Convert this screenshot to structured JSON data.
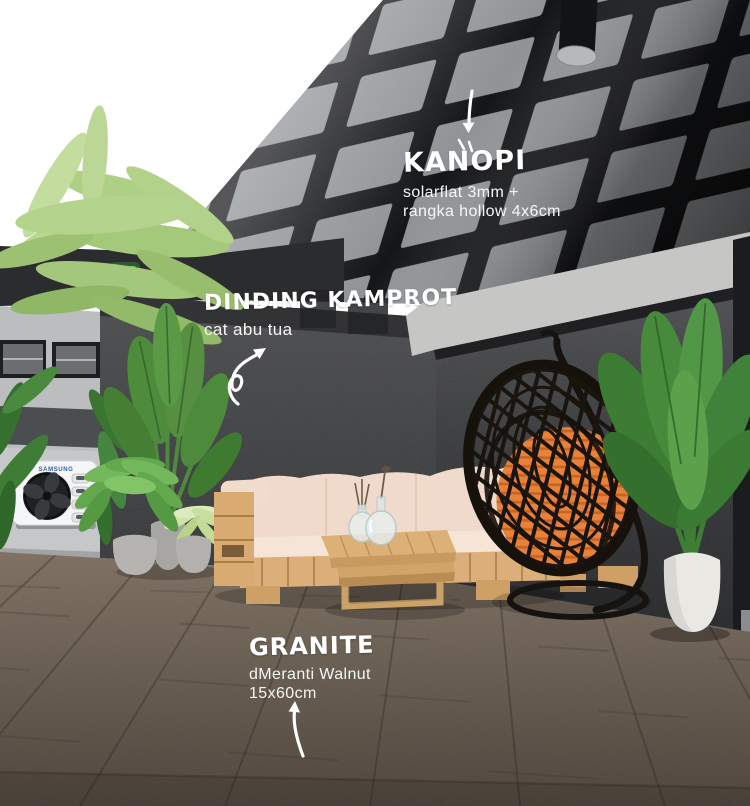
{
  "annotations": {
    "kanopi": {
      "title": "KANOPI",
      "detail_line1": "solarflat 3mm +",
      "detail_line2": "rangka hollow 4x6cm"
    },
    "dinding_kamprot": {
      "title": "DINDING KAMPROT",
      "detail_line1": "cat abu tua"
    },
    "granite": {
      "title": "GRANITE",
      "detail_line1": "dMeranti Walnut",
      "detail_line2": "15x60cm"
    }
  },
  "equipment": {
    "ac_brand": "SAMSUNG"
  },
  "icons": {
    "kanopi_arrow": "arrow-down-icon",
    "dinding_arrow": "curly-arrow-up-right-icon",
    "granite_arrow": "curved-arrow-up-icon"
  },
  "colors": {
    "canopy_frame": "#17181A",
    "canopy_panel": "#8F9396",
    "wall_kamprot": "#3C3D3F",
    "wall_cap": "#C7C7C5",
    "floor_wood": "#6B5E53",
    "sofa_wood": "#DCAE79",
    "sofa_cushion": "#F0DACB",
    "egg_chair_frame": "#17110C",
    "egg_chair_cushion": "#E8813A",
    "foliage_light": "#AED084",
    "foliage_dark": "#4E8C3C",
    "pot_gray": "#B3B1AD",
    "pot_white": "#E9E8E3",
    "ac_body": "#F5F6F7",
    "samsung_blue": "#2E5FA3",
    "signal_light_green": "#46C24A",
    "label_text": "#FFFFFF"
  }
}
